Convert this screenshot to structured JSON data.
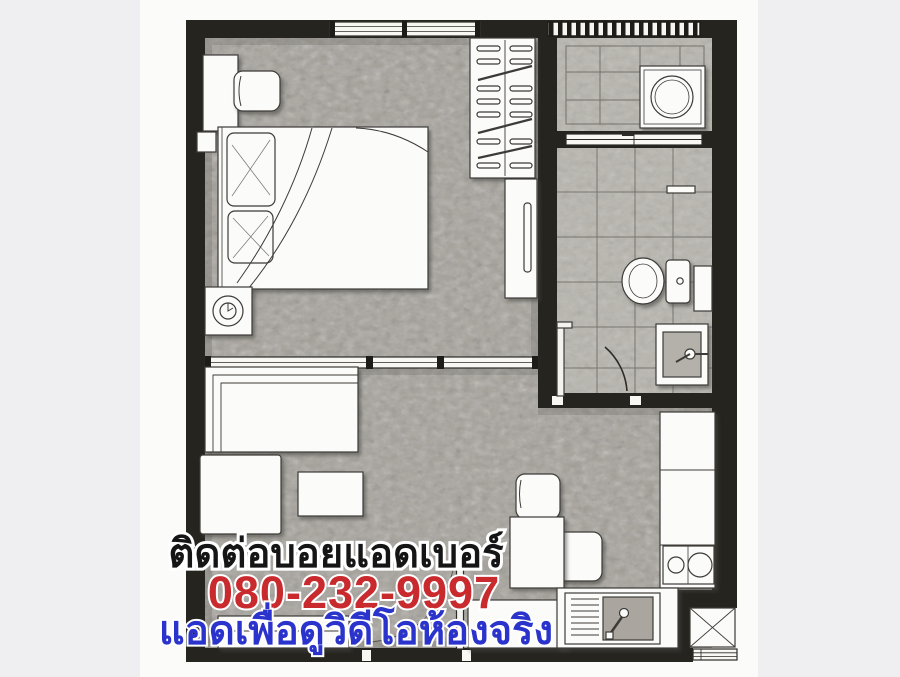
{
  "overlay": {
    "line1": {
      "text": "ติดต่อบอยแอดเบอร์",
      "color": "#151515",
      "outline": "#ffffff"
    },
    "phone": {
      "text": "080-232-9997",
      "color": "#c92a2e",
      "outline": "#ffffff"
    },
    "line3": {
      "text": "แอดเพื่อดูวิดีโอห้องจริง",
      "color": "#2a33cb",
      "outline": "#ffffff"
    }
  },
  "plan": {
    "palette": {
      "wall": "#25241f",
      "floor": "#a5a19a",
      "tile": "#b8b5ae",
      "furniture": "#fbfbf9",
      "paper": "#fbfbf9",
      "backdrop": "#efeef0"
    },
    "depicted_items": [
      "bed",
      "pillows",
      "desk",
      "stool",
      "nightstand-lamp",
      "wardrobe-hangers",
      "tall-cabinet",
      "sliding-partition",
      "sofa",
      "ottoman",
      "coffee-table",
      "tv-console",
      "dining-table",
      "dining-chairs",
      "low-cabinet",
      "washing-machine",
      "balcony-sliding-door",
      "toilet",
      "bathroom-sink",
      "shower-screen",
      "towel-bar",
      "kitchen-counter",
      "stove-two-burners",
      "kitchen-sink",
      "refrigerator",
      "entrance-door",
      "bathroom-door"
    ]
  }
}
